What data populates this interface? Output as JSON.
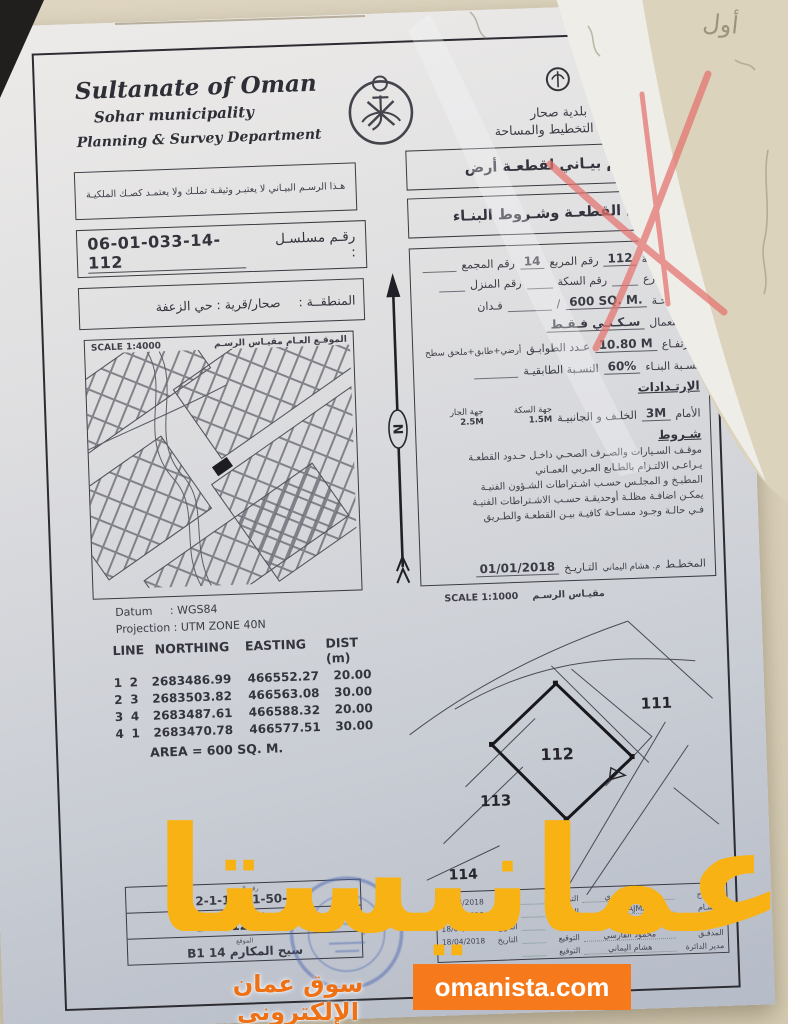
{
  "background": {
    "handwriting_note": "أول"
  },
  "colors": {
    "paper_bg": "#dbd2bc",
    "watermark_yellow": "#f8b214",
    "watermark_orange": "#ee7215",
    "banner_orange": "#f6791b",
    "stamp_blue": "#4e68b2",
    "red_pen": "#e5736f"
  },
  "header": {
    "country_en": "Sultanate of Oman",
    "municipality_en": "Sohar municipality",
    "department_en": "Planning & Survey Department",
    "municipality_ar": "بلدية صحار",
    "department_ar": "دائرة التخطيط والمساحة",
    "doc_title_ar": "رسـم بيـاني لقطعـة أرض",
    "doc_subtitle_ar": "بيـان القطعـة وشـروط البنـاء"
  },
  "disclaimer_ar": "هـذا الرسـم البيـاني لا يعتبـر وثيقـة تملـك ولا يعتمـد كصـك الملكيـة",
  "serial": {
    "label": "رقـم مسلسـل :",
    "value": "06-01-033-14-112"
  },
  "region": {
    "label": "المنطقــة :",
    "value": "صحار/قرية : حي الزعفة"
  },
  "location_map": {
    "title_ar": "الموقـع العـام    مقيـاس الرسـم",
    "scale": "SCALE 1:4000"
  },
  "geo": {
    "datum_label": "Datum",
    "datum_value": ": WGS84",
    "projection_label": "Projection",
    "projection_value": ": UTM ZONE 40N"
  },
  "coords": {
    "headers": [
      "LINE",
      "NORTHING",
      "EASTING",
      "DIST (m)"
    ],
    "rows": [
      [
        "1",
        "2",
        "2683486.99",
        "466552.27",
        "20.00"
      ],
      [
        "2",
        "3",
        "2683503.82",
        "466563.08",
        "30.00"
      ],
      [
        "3",
        "4",
        "2683487.61",
        "466588.32",
        "20.00"
      ],
      [
        "4",
        "1",
        "2683470.78",
        "466577.51",
        "30.00"
      ]
    ],
    "area": "AREA = 600 SQ. M."
  },
  "north_label": "N",
  "plot": {
    "plot_no_label": "رقم القطعة",
    "plot_no": "112",
    "square_label": "رقم المربع",
    "square_no": "14",
    "complex_label": "رقم المجمع",
    "street_label": "رقم الشارع",
    "lane_label": "رقم السكة",
    "house_label": "رقم المنزل",
    "area_label": "المسـاحـة",
    "area_value": "600 SQ. M.",
    "slash": "/",
    "feddan_label": "فـدان",
    "use_label": "الاسـتعمال",
    "use_value": "سـكـنـي فـقـط",
    "height_label": "الارتفـاع",
    "height_value": "10.80 M",
    "floors_label": "عـدد الطوابـق",
    "floors_value": "أرضي+طابق+ملحق سطح",
    "build_ratio_label": "نسـبة البنـاء",
    "build_ratio_value": "60%",
    "floor_ratio_label": "النسـبة الطابقيـة",
    "setbacks_title": "الإرتـدادات",
    "front_label": "الأمام",
    "front_value": "3M",
    "sides_label": "الخلـف و الجانبيـة",
    "lane_side_label": "جهة السكة",
    "lane_side_value": "1.5M",
    "neighbor_side_label": "جهة الجار",
    "neighbor_side_value": "2.5M",
    "conditions_title": "شـروط",
    "conditions": [
      "موقـف السـيارات والصـرف الصحـي داخـل حـدود القطعـة",
      "يـراعـى الالتـزام بالطـابع العـربي العمـاني",
      "المطبـخ و المجلـس حسـب اشـتراطات الشـؤون الفنيـة",
      "يمكـن اضافـة مظلـة أوحديقـة حسـب الاشـتراطات الفنيـة",
      "فـي حالـة وجـود مسـاحة كافيـة بيـن القطعـة والطـريق"
    ],
    "planner_label": "المخطـط",
    "planner_value": "م. هشام اليماني",
    "date_label": "التـاريـخ",
    "date_value": "01/01/2018"
  },
  "site_plan": {
    "title_ar": "مقيـاس الرسـم",
    "scale": "SCALE 1:1000",
    "plot_111": "111",
    "plot_112": "112",
    "plot_113": "113",
    "plot_114": "114"
  },
  "ref_table": {
    "rows": [
      {
        "label": "رقم المرجع",
        "value": "2-1-ـ-50-1-112"
      },
      {
        "label": "رقم الصك السابق",
        "value": "2-1-ـ-50-1-112"
      },
      {
        "label": "الموقع",
        "value": "سيح المكارم 14 B1"
      }
    ]
  },
  "sign_table": {
    "sig_label": "التوقيع",
    "date_label": "التاريخ",
    "rows": [
      {
        "label": "المسـاح",
        "name": "سالم المعمري",
        "date": "18/04/2018"
      },
      {
        "label": "الرسـام",
        "name": "S.ALAJMA",
        "date": "18/04/2018"
      },
      {
        "label": "الإسقاط",
        "name": "S.ALAJMA",
        "date": "18/04/2018"
      },
      {
        "label": "المدقـق",
        "name": "محمود الفارسي",
        "date": "18/04/2018"
      },
      {
        "label": "مدير الدائرة",
        "name": "هشام اليماني",
        "date": ""
      }
    ]
  },
  "watermark": {
    "brand": "عمانيستا",
    "tagline": "سوق عمان الإلكتروني",
    "site": "omanista.com"
  }
}
